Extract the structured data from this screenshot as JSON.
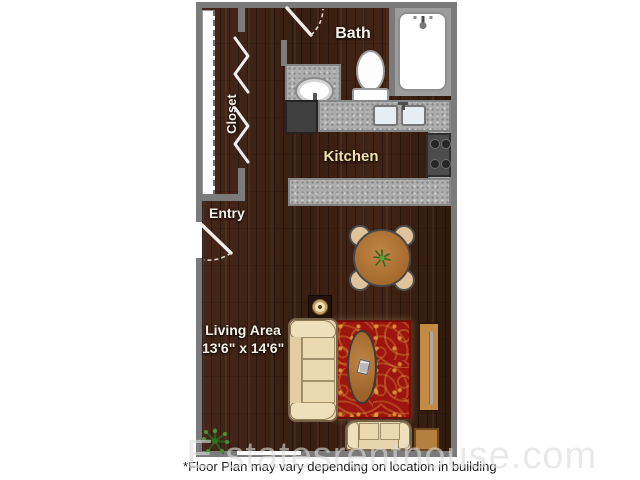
{
  "page": {
    "background_color": "#ffffff"
  },
  "floor_plan": {
    "wall_color": "#7b7b7b",
    "floor_color": "#3c2013",
    "counter_color": "#adadad",
    "rug_color": "#9e1510",
    "rug_accent_color": "#d69634",
    "upholstery_color": "#e7d4ac",
    "wood_furniture_color": "#b0763a",
    "labels": {
      "bath": "Bath",
      "closet": "Closet",
      "kitchen": "Kitchen",
      "entry": "Entry",
      "living_area": "Living Area",
      "living_area_dimensions": "13'6\" x 14'6\""
    },
    "fixtures": [
      "bathtub",
      "toilet",
      "bathroom-sink",
      "kitchen-sink",
      "refrigerator",
      "stove",
      "dining-table",
      "dining-chair",
      "sofa",
      "coffee-table",
      "area-rug",
      "tv-console",
      "table-lamp",
      "loveseat",
      "end-table",
      "potted-plant"
    ]
  },
  "watermark": {
    "prefix": "E",
    "text": "statesrenthouse.com"
  },
  "footnote": "*Floor Plan may vary depending on location in building"
}
